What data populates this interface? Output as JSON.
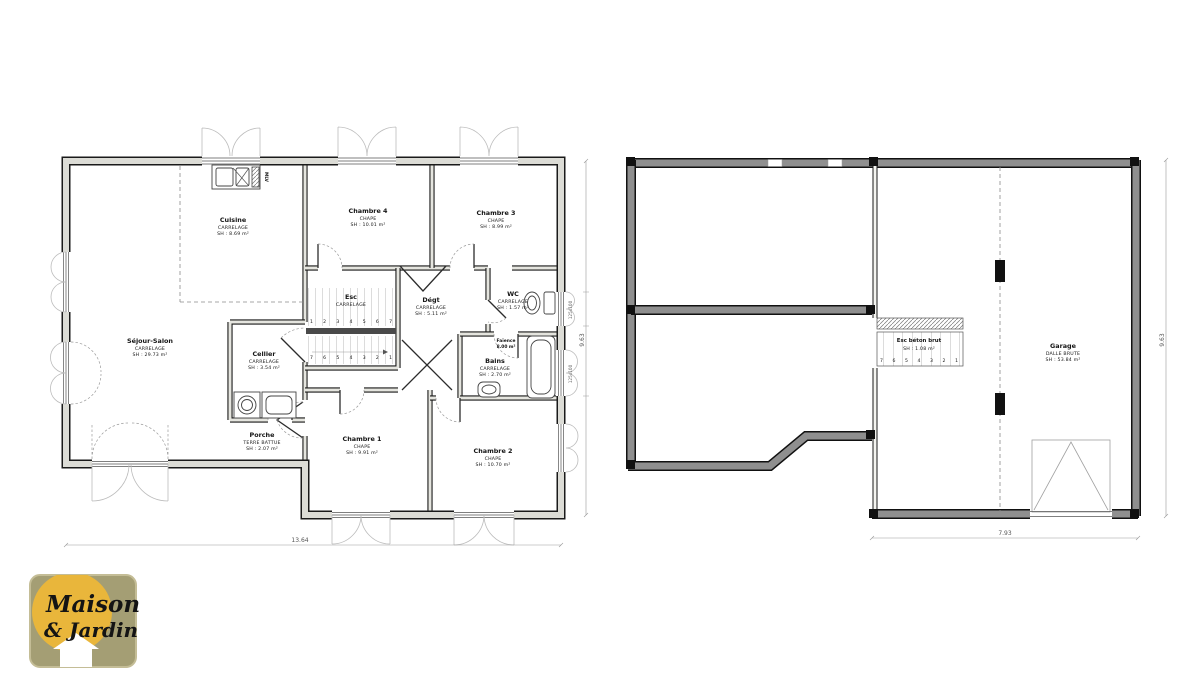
{
  "floor_plan": {
    "rooms": {
      "sejour": {
        "name": "Séjour-Salon",
        "finish": "CARRELAGE",
        "area": "SH : 29.73 m²"
      },
      "cuisine": {
        "name": "Cuisine",
        "finish": "CARRELAGE",
        "area": "SH : 8.69 m²"
      },
      "cellier": {
        "name": "Cellier",
        "finish": "CARRELAGE",
        "area": "SH : 3.54 m²"
      },
      "porche": {
        "name": "Porche",
        "finish": "TERRE BATTUE",
        "area": "SH : 2.07 m²"
      },
      "chambre4": {
        "name": "Chambre 4",
        "finish": "CHAPE",
        "area": "SH : 10.01 m²"
      },
      "chambre3": {
        "name": "Chambre 3",
        "finish": "CHAPE",
        "area": "SH : 8.99 m²"
      },
      "degt": {
        "name": "Dégt",
        "finish": "CARRELAGE",
        "area": "SH : 5.11 m²"
      },
      "wc": {
        "name": "WC",
        "finish": "CARRELAGE",
        "area": "SH : 1.57 m²"
      },
      "bains": {
        "name": "Bains",
        "finish": "CARRELAGE",
        "area": "SH : 2.70 m²"
      },
      "chambre1": {
        "name": "Chambre 1",
        "finish": "CHAPE",
        "area": "SH : 9.91 m²"
      },
      "chambre2": {
        "name": "Chambre 2",
        "finish": "CHAPE",
        "area": "SH : 10.70 m²"
      }
    },
    "stairs": {
      "label": "Esc",
      "finish": "CARRELAGE",
      "numbers_up": "1 2 3 4 5 6 7",
      "numbers_down": "7 6 5 4 3 2 1"
    },
    "kitchen": {
      "mlv_label": "MLV"
    },
    "bath_note": {
      "line1": "Faïence",
      "line2": "8.00 m²"
    },
    "window_labels": [
      "125x100",
      "125x100"
    ],
    "dimensions": {
      "bottom": "13.64",
      "right": "9.63"
    }
  },
  "basement_plan": {
    "stairs": {
      "label": "Esc béton brut",
      "area": "SH : 1.08 m²",
      "numbers": "7 6 5 4 3 2 1"
    },
    "garage": {
      "name": "Garage",
      "finish": "DALLE BRUTE",
      "area": "SH : 53.84 m²"
    },
    "dimensions": {
      "bottom": "7.93",
      "right": "9.63"
    }
  },
  "logo": {
    "line1": "Maison",
    "line2": "& Jardin"
  },
  "colors": {
    "wall_hatch": "#dcdcd6",
    "basement_wall": "#8f8f8f",
    "logo_bg": "#a49e74",
    "logo_circle": "#e9b63b",
    "logo_text": "#76241f",
    "logo_house": "#ffffff"
  }
}
